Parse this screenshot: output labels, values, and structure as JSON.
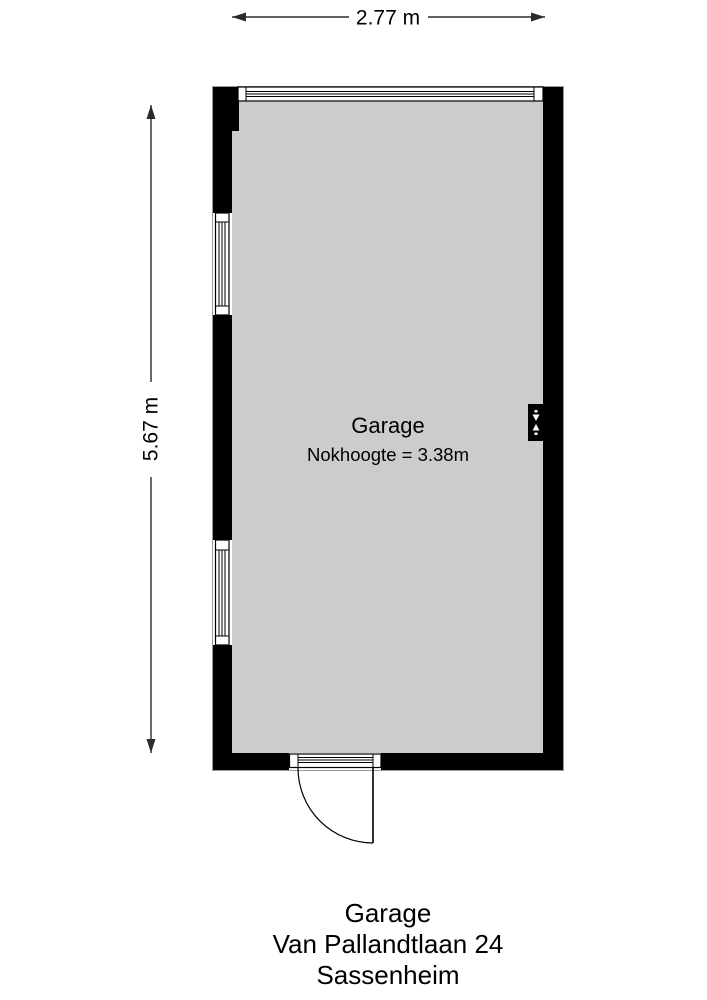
{
  "colors": {
    "wall": "#000000",
    "floor": "#cccccc",
    "dimension_line": "#2b2b2b"
  },
  "dimensions": {
    "width": "2.77 m",
    "height": "5.67 m"
  },
  "room": {
    "name": "Garage",
    "ridge_height": "Nokhoogte = 3.38m"
  },
  "caption": {
    "title": "Garage",
    "address": "Van Pallandtlaan 24",
    "city": "Sassenheim"
  }
}
